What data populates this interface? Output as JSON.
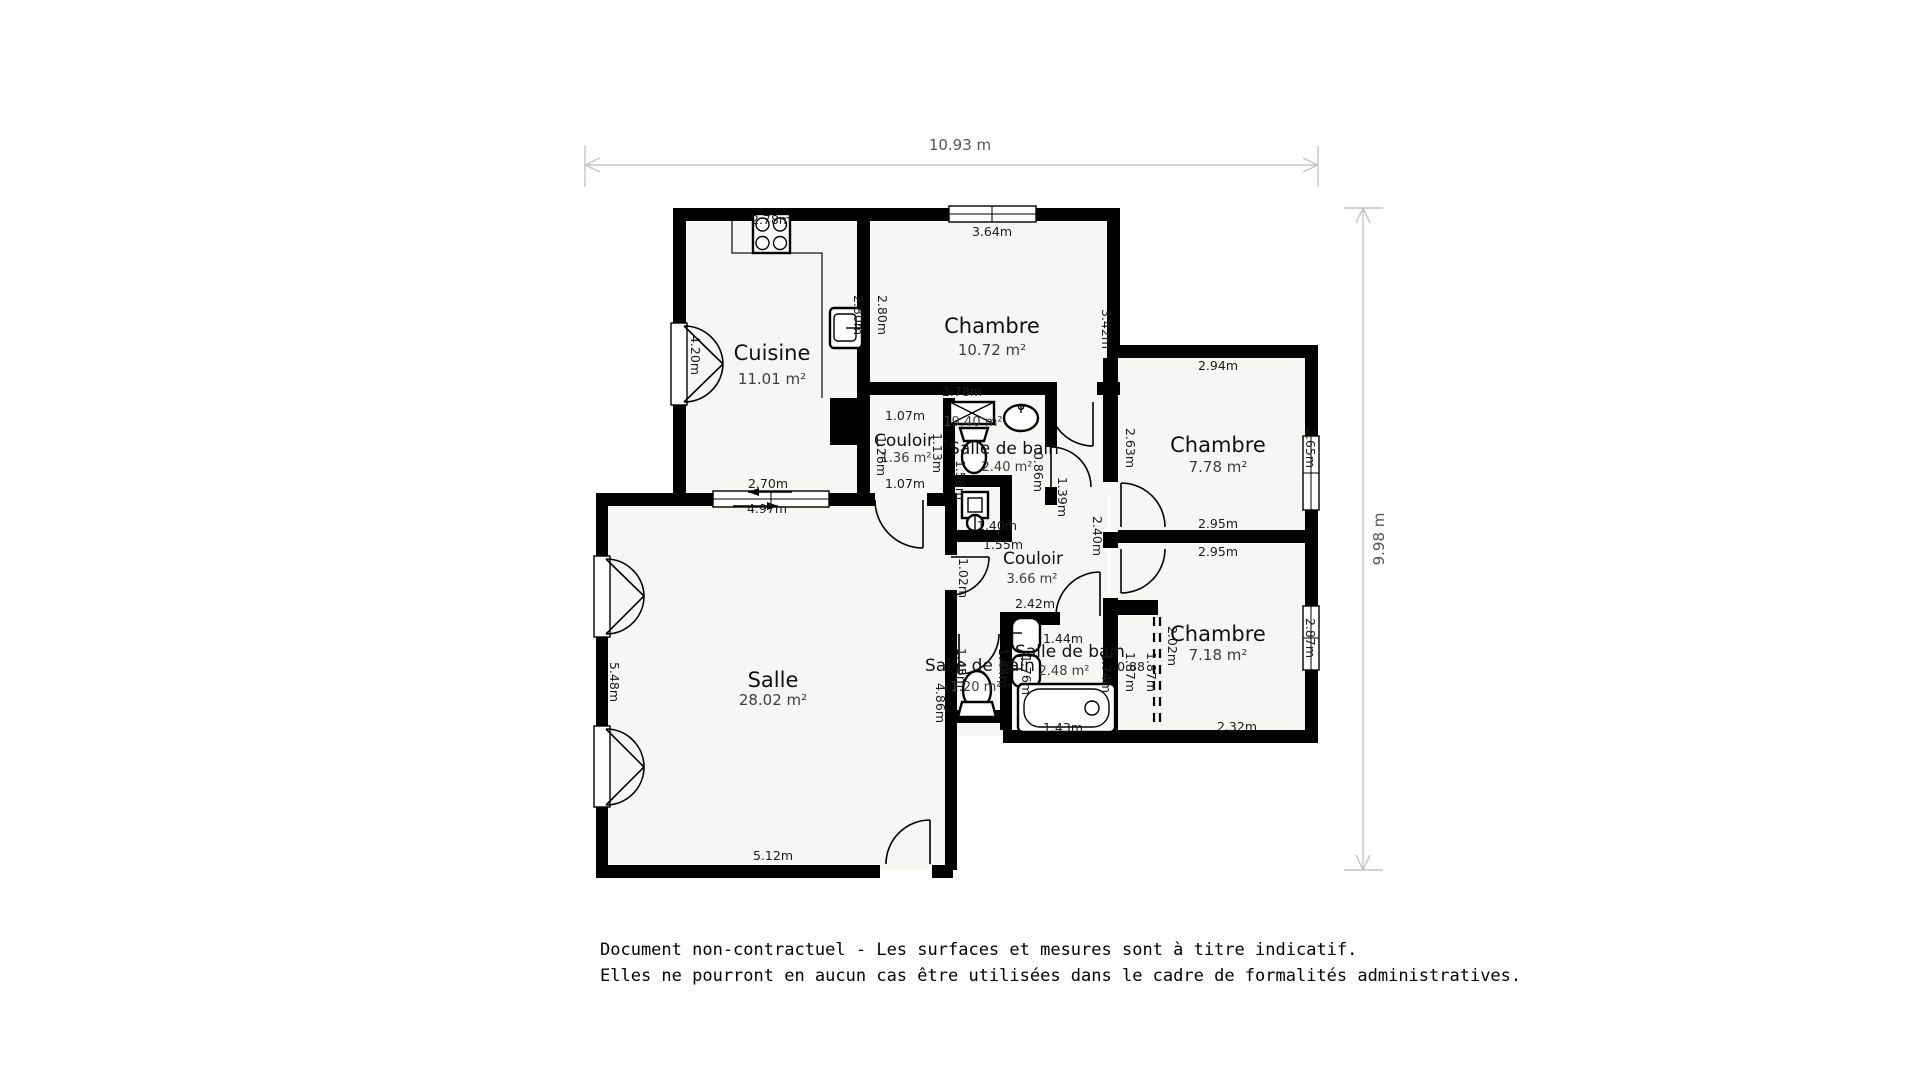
{
  "measure": {
    "total_width": "10.93 m",
    "total_height": "9.98 m"
  },
  "rooms": [
    {
      "name": "Cuisine",
      "area": "11.01 m²"
    },
    {
      "name": "Chambre",
      "area": "10.72 m²"
    },
    {
      "name": "Chambre",
      "area": "7.78 m²"
    },
    {
      "name": "Chambre",
      "area": "7.18 m²"
    },
    {
      "name": "Salle",
      "area": "28.02 m²"
    },
    {
      "name": "Couloir",
      "area": "1.36 m²"
    },
    {
      "name": "Salle de bain",
      "area": "2.40 m²"
    },
    {
      "name": "Couloir",
      "area": "3.66 m²"
    },
    {
      "name": "Salle de bain",
      "area": "2.48 m²"
    },
    {
      "name": "Salle de bain",
      "area": "1.20 m²"
    }
  ],
  "dims": {
    "kitchen_top": "2.78m",
    "kitchen_door": "4.20m",
    "kitchen_sink": "2.80m",
    "chambre1_left": "2.80m",
    "salle_win_top_a": "2.70m",
    "salle_win_top_b": "4.97m",
    "chambre1_win": "3.64m",
    "chambre1_right": "3.42m",
    "chambre1_bottom": "2.78m",
    "couloir1_top": "1.07m",
    "couloir1_left": "1.26m",
    "couloir1_right": "1.13m",
    "couloir1_bottom": "1.07m",
    "sdb1_alt_area": "19.40 m²",
    "sdb1_left": "1.58m",
    "sdb1_right": "0.86m",
    "sdb1_door": "1.39m",
    "wc_width": "1.40m",
    "couloir2_top": "1.55m",
    "couloir2_left": "1.02m",
    "couloir2_bottom": "2.42m",
    "couloir2_right": "2.40m",
    "chambre2_top": "2.94m",
    "chambre2_left": "2.63m",
    "chambre2_right": "2.65m",
    "chambre2_bottom": "2.95m",
    "chambre3_top": "2.95m",
    "chambre3_right": "2.87m",
    "chambre3_bottom": "2.32m",
    "chambre3_closet_w": "0.88",
    "chambre3_closet_h": "2.02m",
    "chambre3_left_a": "1.87m",
    "chambre3_left_b": "1.87m",
    "sdb2_top": "1.44m",
    "sdb2_right": "1.74m",
    "sdb2_left": "1.76m",
    "sdb2_tub": "1.43m",
    "sdb3_left": "1.45m",
    "sdb3_right": "1.44m",
    "salle_left": "5.48m",
    "salle_right": "4.86m",
    "salle_bottom": "5.12m"
  },
  "footer": {
    "line1": "Document non-contractuel - Les surfaces et mesures sont à titre indicatif.",
    "line2": "Elles ne pourront en aucun cas être utilisées dans le cadre de formalités administratives."
  }
}
